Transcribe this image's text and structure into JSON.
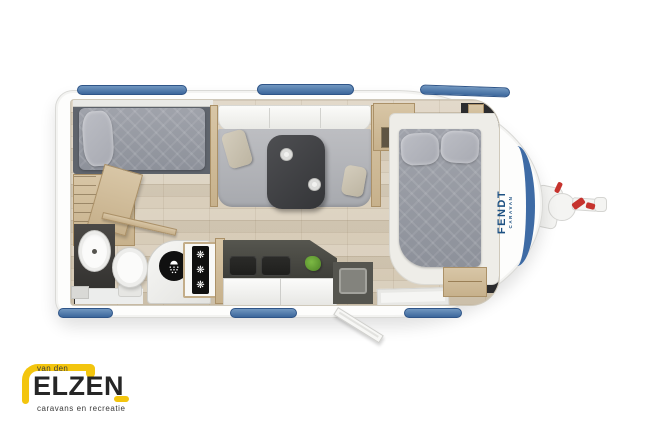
{
  "background": "#ffffff",
  "logo": {
    "prefix": "van den",
    "name": "ELZEN",
    "tagline": "caravans en recreatie",
    "accent_color": "#f3c50e",
    "text_color": "#262626"
  },
  "caravan": {
    "brand": "FENDT",
    "brand_sub": "CARAVAN",
    "brand_color": "#1d5183",
    "window_color": "#44719f",
    "nose_accent_color": "#3e6ba5",
    "hitch_handle_color": "#c6332e",
    "fridge": {
      "snowflake": "❋"
    },
    "floorplan_features": [
      "single-bed",
      "wardrobe",
      "washbasin",
      "toilet",
      "shower",
      "fridge",
      "kitchen-hob",
      "kitchen-sink",
      "dinette-bench",
      "dinette-table",
      "double-bed",
      "overhead-locker",
      "bedside-cabinet",
      "entry-door",
      "tow-hitch",
      "windows"
    ]
  }
}
